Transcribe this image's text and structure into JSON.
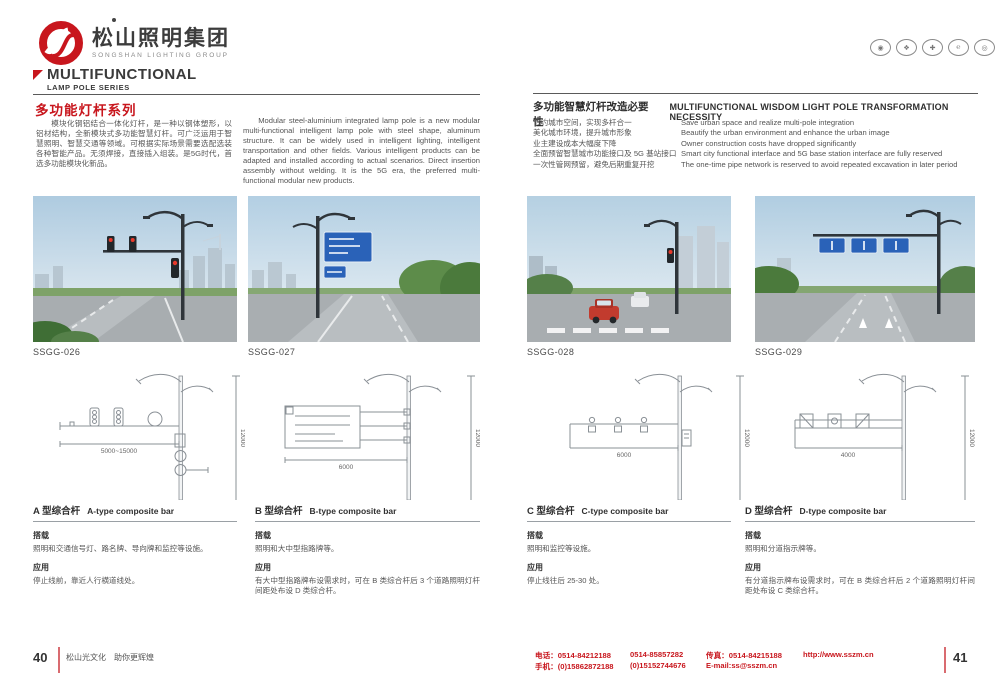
{
  "colors": {
    "brand_red": "#c8161d",
    "text_dark": "#3f3f3f",
    "text_gray": "#555555",
    "line_gray": "#8a9096",
    "sign_blue": "#2a62b8",
    "signal_red": "#e8392b"
  },
  "brand": {
    "logo_cn": "松山照明集团",
    "logo_en": "SONGSHAN LIGHTING GROUP",
    "cert_badges": [
      "◉",
      "❖",
      "✚",
      "℮",
      "◎"
    ]
  },
  "series": {
    "title_en": "MULTIFUNCTIONAL",
    "subtitle_en": "LAMP POLE SERIES",
    "title_cn": "多功能灯杆系列"
  },
  "intro": {
    "cn": "模块化钢铝结合一体化灯杆，是一种以钢体塑形，以铝材结构，全新模块式多功能智慧灯杆。可广泛运用于智慧照明、智慧交通等领域。可根据实际场景需要选配选装各种智能产品。无须焊接，直接插入组装。是5G时代，首选多功能模块化新品。",
    "en": "Modular steel-aluminium integrated lamp pole is a new modular multi-functional intelligent lamp pole with steel shape, aluminum structure. It can be widely used in intelligent lighting, intelligent transportation and other fields. Various intelligent products can be adapted and installed according to actual scenarios. Direct insertion assembly without welding. It is the 5G era, the preferred multi-functional modular new products."
  },
  "necessity": {
    "title_cn": "多功能智慧灯杆改造必要性",
    "title_en": "MULTIFUNCTIONAL WISDOM LIGHT POLE TRANSFORMATION NECESSITY",
    "items": [
      {
        "cn": "节约城市空间，实现多杆合一",
        "en": "Save urban space and realize multi-pole integration"
      },
      {
        "cn": "美化城市环境，提升城市形象",
        "en": "Beautify the urban environment and enhance the urban image"
      },
      {
        "cn": "业主建设成本大幅度下降",
        "en": "Owner construction costs have dropped significantly"
      },
      {
        "cn": "全面预留智慧城市功能接口及 5G 基站接口",
        "en": "Smart city functional interface and 5G base station interface are fully reserved"
      },
      {
        "cn": "一次性管网预留，避免后期重复开挖",
        "en": "The one-time pipe network is reserved to avoid repeated excavation in later period"
      }
    ]
  },
  "photos": [
    {
      "code": "SSGG-026"
    },
    {
      "code": "SSGG-027"
    },
    {
      "code": "SSGG-028"
    },
    {
      "code": "SSGG-029"
    }
  ],
  "labels": {
    "load": "搭载",
    "app": "应用"
  },
  "types": [
    {
      "name_cn": "A 型综合杆",
      "name_en": "A-type composite bar",
      "load": "照明和交通信号灯、路名牌、导向牌和监控等设施。",
      "app": "停止线前，靠近人行横道线处。",
      "dim_w": "5000~15000",
      "dim_h": "12000"
    },
    {
      "name_cn": "B 型综合杆",
      "name_en": "B-type composite bar",
      "load": "照明和大中型指路牌等。",
      "app": "有大中型指路牌布设需求时，可在 B 类综合杆后 3 个道路照明灯杆间距处布设 D 类综合杆。",
      "dim_w": "6000",
      "dim_h": "12000"
    },
    {
      "name_cn": "C 型综合杆",
      "name_en": "C-type composite bar",
      "load": "照明和监控等设施。",
      "app": "停止线往后 25-30 处。",
      "dim_w": "6000",
      "dim_h": "12000"
    },
    {
      "name_cn": "D 型综合杆",
      "name_en": "D-type composite bar",
      "load": "照明和分道指示牌等。",
      "app": "有分道指示牌布设需求时，可在 B 类综合杆后 2 个道路照明灯杆间距处布设 C 类综合杆。",
      "dim_w": "4000",
      "dim_h": "12000"
    }
  ],
  "footer": {
    "page_left": "40",
    "tagline": "松山光文化　助你更辉煌",
    "contact": {
      "tel1": "电话：0514-84212188",
      "tel2": "0514-85857282",
      "fax": "传真：0514-84215188",
      "url": "http://www.sszm.cn",
      "mob1": "手机：(0)15862872188",
      "mob2": "(0)15152744676",
      "email": "E-mail:ss@sszm.cn"
    },
    "page_right": "41"
  }
}
